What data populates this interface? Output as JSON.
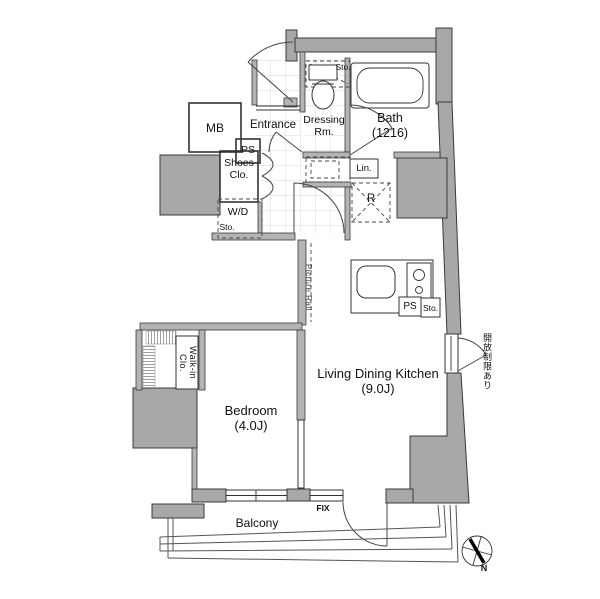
{
  "plan": {
    "entry": {
      "mb": "MB",
      "ps": "PS",
      "entrance": "Entrance",
      "shoes_closet": [
        "Shoes",
        "Clo."
      ],
      "wd_closet": "W/D",
      "wd_closet_sub": "Sto."
    },
    "sanitary": {
      "dressing_room": [
        "Dressing",
        "Rm."
      ],
      "toilet_storage": "Sto.",
      "bath": [
        "Bath",
        "(1216)"
      ],
      "linen": "Lin."
    },
    "kitchen": {
      "refrigerator": "R",
      "pipe_space": "PS",
      "storage": "Sto."
    },
    "rooms": {
      "ldk": [
        "Living Dining Kitchen",
        "(9.0J)"
      ],
      "bedroom": [
        "Bedroom",
        "(4.0J)"
      ],
      "walk_in_closet": "Walk-in Clo."
    },
    "annotations": {
      "picture_rail": "Picture Rail",
      "opening_restriction": "開放制限あり",
      "fix_window": "FIX",
      "balcony": "Balcony",
      "compass_north": "N"
    },
    "colors": {
      "wall_fill": "#a8a8a8",
      "wall_edge": "#3a3a3a",
      "line": "#333333",
      "tile_line": "#cccccc",
      "background": "#ffffff"
    }
  }
}
